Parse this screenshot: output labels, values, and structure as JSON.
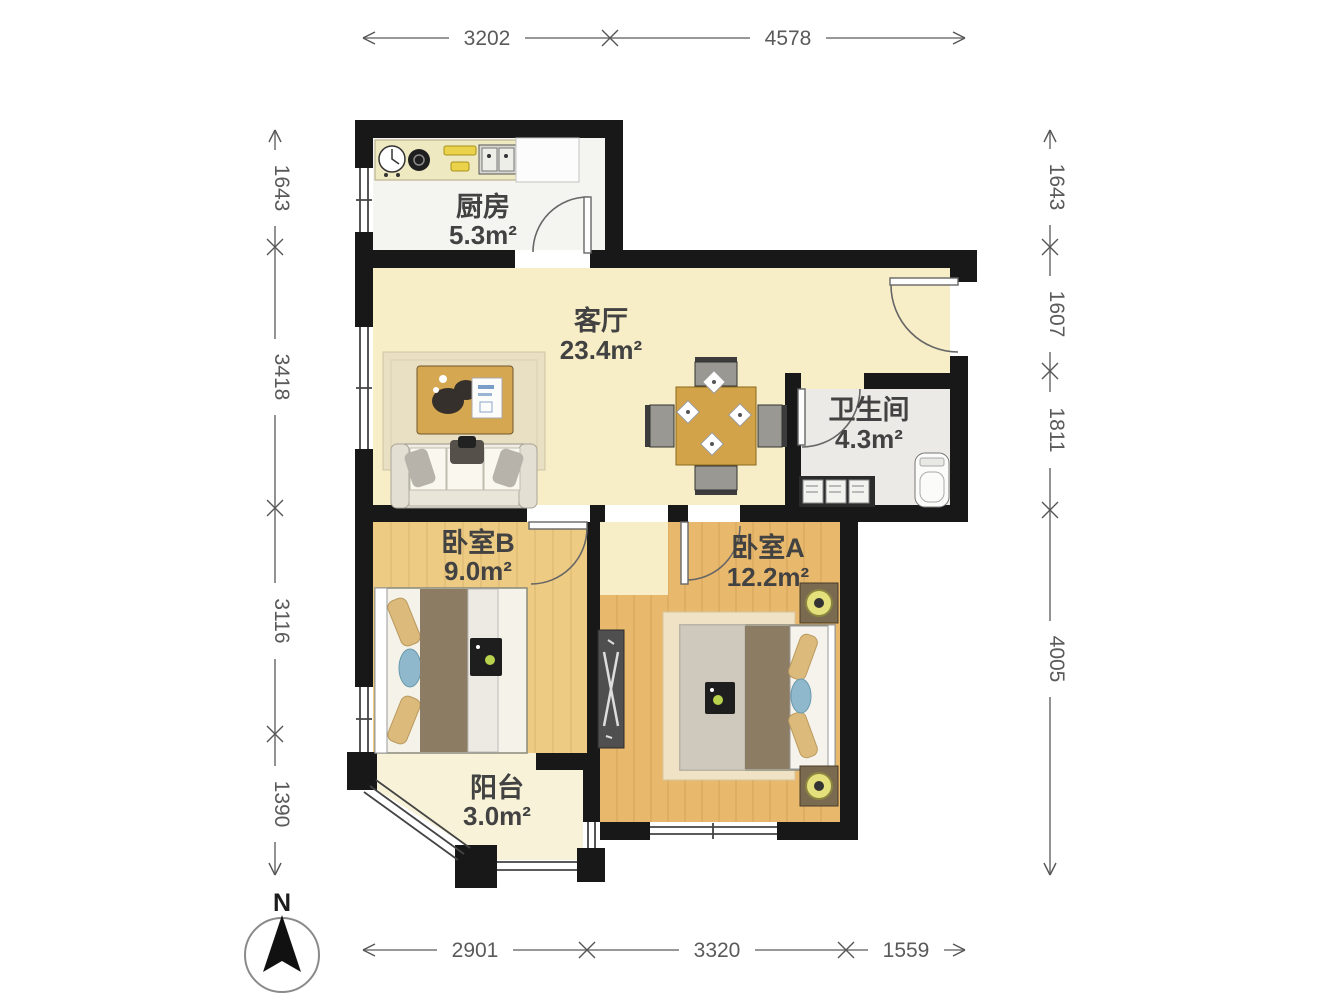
{
  "floorplan": {
    "rooms": {
      "kitchen": {
        "name": "厨房",
        "area": "5.3m²"
      },
      "living": {
        "name": "客厅",
        "area": "23.4m²"
      },
      "bathroom": {
        "name": "卫生间",
        "area": "4.3m²"
      },
      "bedroomB": {
        "name": "卧室B",
        "area": "9.0m²"
      },
      "bedroomA": {
        "name": "卧室A",
        "area": "12.2m²"
      },
      "balcony": {
        "name": "阳台",
        "area": "3.0m²"
      }
    },
    "dimensions": {
      "top": [
        "3202",
        "4578"
      ],
      "bottom": [
        "2901",
        "3320",
        "1559"
      ],
      "left": [
        "1643",
        "3418",
        "3116",
        "1390"
      ],
      "right": [
        "1643",
        "1607",
        "1811",
        "4005"
      ]
    },
    "compass": {
      "north_label": "N"
    },
    "colors": {
      "wall": "#181818",
      "living_floor": "#f7edc6",
      "kitchen_floor": "#f4f4f0",
      "bath_floor": "#eceae6",
      "bedroomB_floor": "#edcb83",
      "bedroomA_floor": "#e8b96d",
      "balcony_floor": "#f8f3d8",
      "wood_accent": "#d2a348",
      "dim_text": "#5a5a5a"
    }
  }
}
